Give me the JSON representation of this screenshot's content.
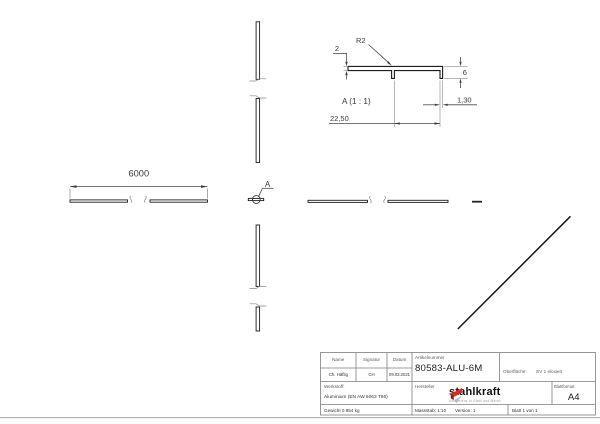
{
  "drawing": {
    "front_view": {
      "length_dim": "6000",
      "detail_callout": "A"
    },
    "detail_view": {
      "title": "A (1 : 1)",
      "dim_thickness": "2",
      "dim_radius": "R2",
      "dim_height": "6",
      "dim_wall": "1,30",
      "dim_width": "22,50"
    }
  },
  "title_block": {
    "name_label": "Name",
    "signatur_label": "Signatur",
    "datum_label": "Datum",
    "name_value": "Ch. Häflig",
    "signatur_value": "CH",
    "datum_value": "09.03.2021",
    "artikelnummer_label": "Artikelnummer",
    "artikelnummer_value": "80583-ALU-6M",
    "oberflaeche_label": "Oberfläche:",
    "oberflaeche_value": "EV 1 eloxiert",
    "werkstoff_label": "Werkstoff:",
    "werkstoff_value": "Aluminium (EN AW 6063 T66)",
    "gewicht_value": "Gewicht 0.954 kg",
    "hersteller_label": "Hersteller",
    "hersteller_logo": "stahlkraft",
    "hersteller_tagline": "Kompetenz in Stahl und Metall",
    "blattformat_label": "Blattformat",
    "blattformat_value": "A4",
    "massstab_value": "Massstab: 1:10",
    "version_value": "Version: 1",
    "blatt_value": "Blatt 1 von 1"
  },
  "colors": {
    "line_dark": "#1c1c1c",
    "line_dim": "#4a4a4a",
    "line_thin": "#8a8a8a",
    "frame": "#7d7d7d",
    "logo_red": "#d92b26",
    "logo_dark_red": "#8e1b1e",
    "logo_gray": "#bdbdbd"
  }
}
